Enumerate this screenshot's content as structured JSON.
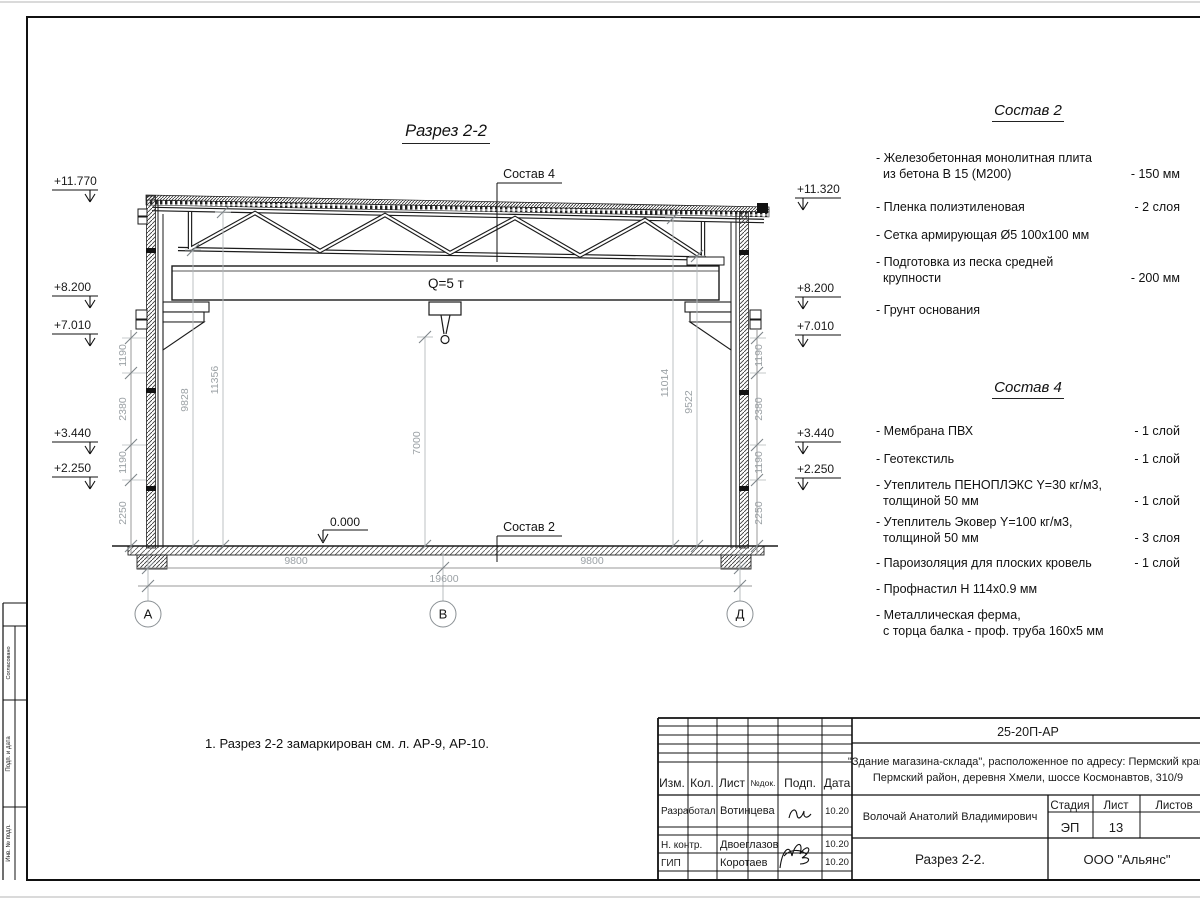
{
  "sec": {
    "title": "Разрез 2-2",
    "crane": "Q=5 т",
    "callout_roof": "Состав 4",
    "callout_floor": "Состав 2",
    "zero": "0.000",
    "elevL": [
      "+11.770",
      "+8.200",
      "+7.010",
      "+3.440",
      "+2.250"
    ],
    "elevR": [
      "+11.320",
      "+8.200",
      "+7.010",
      "+3.440",
      "+2.250"
    ],
    "wallDims": [
      "1190",
      "2380",
      "1190",
      "2250"
    ],
    "innerDims": [
      "9828",
      "11356",
      "7000",
      "11014",
      "9522"
    ],
    "bottomDims": [
      "9800",
      "9800",
      "19600"
    ],
    "axes": [
      "А",
      "В",
      "Д"
    ],
    "note": "1. Разрез 2-2 замаркирован см. л. АР-9, АР-10."
  },
  "comp2": {
    "title": "Состав 2",
    "items": [
      {
        "l1": "- Железобетонная  монолитная плита",
        "l2": "из бетона В 15 (М200)",
        "v": "- 150 мм"
      },
      {
        "l1": "- Пленка полиэтиленовая",
        "v": "-  2 слоя"
      },
      {
        "l1": "- Сетка армирующая Ø5 100х100 мм",
        "v": ""
      },
      {
        "l1": "- Подготовка из песка средней",
        "l2": "крупности",
        "v": "- 200 мм"
      },
      {
        "l1": "- Грунт основания",
        "v": ""
      }
    ]
  },
  "comp4": {
    "title": "Состав 4",
    "items": [
      {
        "l1": "- Мембрана ПВХ",
        "v": "- 1 слой"
      },
      {
        "l1": "- Геотекстиль",
        "v": "- 1 слой"
      },
      {
        "l1": "- Утеплитель ПЕНОПЛЭКС Y=30 кг/м3,",
        "l2": "толщиной 50 мм",
        "v": "- 1 слой"
      },
      {
        "l1": "- Утеплитель Эковер Y=100 кг/м3,",
        "l2": "толщиной 50 мм",
        "v": "- 3 слоя"
      },
      {
        "l1": "- Пароизоляция для плоских кровель",
        "v": "- 1 слой"
      },
      {
        "l1": "- Профнастил Н 114х0.9 мм",
        "v": ""
      },
      {
        "l1": "- Металлическая ферма,",
        "l2": "с торца балка - проф. труба 160х5 мм",
        "v": ""
      }
    ]
  },
  "stamp": {
    "doc": "25-20П-АР",
    "obj1": "\"Здание магазина-склада\", расположенное по адресу: Пермский край,",
    "obj2": "Пермский район, деревня Хмели, шоссе Космонавтов, 310/9",
    "cols": [
      "Изм.",
      "Кол.",
      "Лист",
      "№док.",
      "Подп.",
      "Дата"
    ],
    "r1role": "Разработал",
    "r1name": "Вотинцева",
    "r1date": "10.20",
    "r2role": "Н. контр.",
    "r2name": "Двоеглазов",
    "r2date": "10.20",
    "r3role": "ГИП",
    "r3name": "Коротаев",
    "r3date": "10.20",
    "chief": "Волочай Анатолий Владимирович",
    "stage_l": "Стадия",
    "sheet_l": "Лист",
    "sheets_l": "Листов",
    "stage": "ЭП",
    "sheet": "13",
    "title": "Разрез 2-2.",
    "company": "ООО \"Альянс\""
  },
  "side": {
    "s1": "Согласовано",
    "s2": "Подп. и дата",
    "s3": "Инв. № подл."
  }
}
